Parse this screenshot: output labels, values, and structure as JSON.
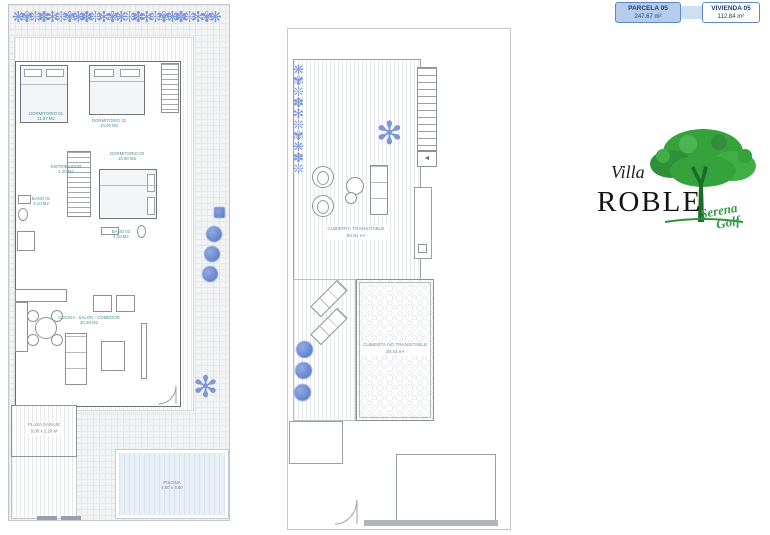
{
  "info_panel": {
    "parcela": {
      "label": "PARCELA 05",
      "area": "247.67 m²"
    },
    "vivienda": {
      "label": "VIVIENDA 05",
      "area": "112.84 m²"
    }
  },
  "logo": {
    "villa": "Villa",
    "roble": "ROBLE",
    "serena": "Serena",
    "golf": "Golf"
  },
  "ground_floor": {
    "dormitorio1": {
      "name": "DORMITORIO 01",
      "area": "11.87 M2"
    },
    "dormitorio2": {
      "name": "DORMITORIO 02",
      "area": "10.46 M2"
    },
    "dormitorio3": {
      "name": "DORMITORIO 03",
      "area": "10.80 M2"
    },
    "distribuidor": {
      "name": "DISTRIBUIDOR",
      "area": "4.20 M2"
    },
    "bano1": {
      "name": "BAÑO 01",
      "area": "4.10 M2"
    },
    "bano2": {
      "name": "BAÑO 02",
      "area": "4.10 M2"
    },
    "salon": {
      "name": "COCINA - SALÓN - COMEDOR",
      "area": "40.29 M2"
    },
    "garaje": {
      "name": "PLAZA GARAJE",
      "area": "5.00 x 2.20 M"
    },
    "piscina": {
      "name": "PISCINA",
      "area": "4.60 x 3.00"
    }
  },
  "roof": {
    "transitable": {
      "name": "CUBIERTA TRANSITABLE",
      "area": "84.91 m²"
    },
    "no_transitable": {
      "name": "CUBIERTA NO TRANSITABLE",
      "area": "28.44 m²"
    }
  },
  "icons": {
    "hedge_glyphs": "❋✾❊✽✻❊✾❋✽❊✻✾❋❊✽✻❊✾❋✽❊✻✾❋",
    "plant_column_glyphs": "❋✾❊✽✻❊✾❋✽❊",
    "palm_glyph": "✻",
    "stair_arrow": "◄"
  },
  "colors": {
    "accent_blue": "#5d87c6",
    "info_fill": "#b5cdea",
    "navy_text": "#1c3b73",
    "plant_blue": "#7e97d8",
    "bush_blue": "#5f7fcc",
    "label_teal": "#4f9390",
    "label_roof_blue": "#6b87b5",
    "logo_green": "#2f9e41",
    "pool_fill": "#e9eff6",
    "wall_gray": "#6a6f76"
  }
}
